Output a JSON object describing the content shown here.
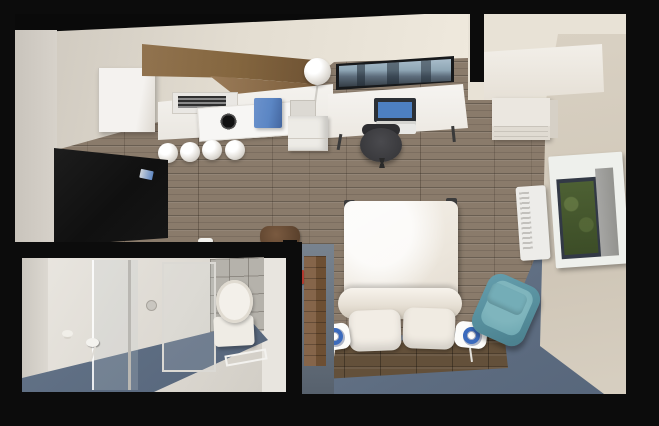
{
  "scene": {
    "title": "Overhead 3D rendering of a compact studio apartment with kitchen, work desk, bed and bathroom",
    "type": "architectural-interior-render",
    "view": "top-down bird's-eye",
    "rooms": {
      "living_bedroom": "open room with wood plank flooring, blue-gray carpet zone, bed on wood platform, desk and kitchen along top wall",
      "kitchen": "upper-left corner kitchenette with walnut upper cabinets, white counter, two-burner cooktop and range hood",
      "bathroom": "lower-left enclosed bathroom with glass shower screen, toilet, tiled wall and blue bath mats"
    },
    "objects": {
      "kitchen": [
        "walnut-upper-cabinets",
        "range-hood",
        "two-burner-cooktop",
        "blue-counter-bin",
        "white-tall-cabinet",
        "pendant-sphere-lights-x4"
      ],
      "living": [
        "black-wall-tv-panel",
        "floor-lamp-sphere",
        "white-desk",
        "laptop",
        "keyboard",
        "dark-office-chair",
        "wall-mounted-tv-skyline",
        "drawer-unit",
        "small-printer",
        "duffel-bag",
        "faucet-fitting"
      ],
      "storage": [
        "white-wardrobe",
        "white-dresser"
      ],
      "bedroom": [
        "double-bed-white-duvet",
        "duvet-fold-roll",
        "two-pillows",
        "dark-wood-bed-platform",
        "bedside-lamp-left",
        "bedside-lamp-right",
        "teal-armchair",
        "blue-gray-carpet"
      ],
      "right_wall": [
        "air-conditioner-unit",
        "window-green-view",
        "window-roller-screen"
      ],
      "partition": [
        "gray-partition-wall",
        "wood-accent-panel",
        "red-switch-box"
      ],
      "bathroom": [
        "glass-shower-screen",
        "shower-door-frame",
        "shower-head",
        "toilet",
        "gray-tile-wall",
        "blue-bath-mat",
        "towel-bar",
        "shower-stool",
        "floor-drain"
      ]
    },
    "palette": {
      "outer_walls": "#0c0c0c",
      "top_wall_face": "#e9e3d7",
      "left_wall_face": "#d3cec6",
      "right_wall_face": "#d5cdbf",
      "wood_floor": "#8a7b6b",
      "plank_seam": "#5f5449",
      "blue_carpet": "#64748a",
      "cabinet_walnut": "#8b6d4f",
      "counter_white": "#f2f0ec",
      "bin_blue": "#5b86c4",
      "tv_black": "#141414",
      "laptop_screen_blue": "#4d80c2",
      "bed_white": "#f1ede6",
      "platform_wood": "#63503a",
      "lamp_ring_blue": "#3b6bbd",
      "armchair_teal": "#6ba7b2",
      "window_green": "#47592f",
      "toilet_white": "#efece5",
      "tile_gray": "#b5b2ab",
      "partition_gray": "#6b7683",
      "accent_red": "#b23a2f"
    }
  }
}
